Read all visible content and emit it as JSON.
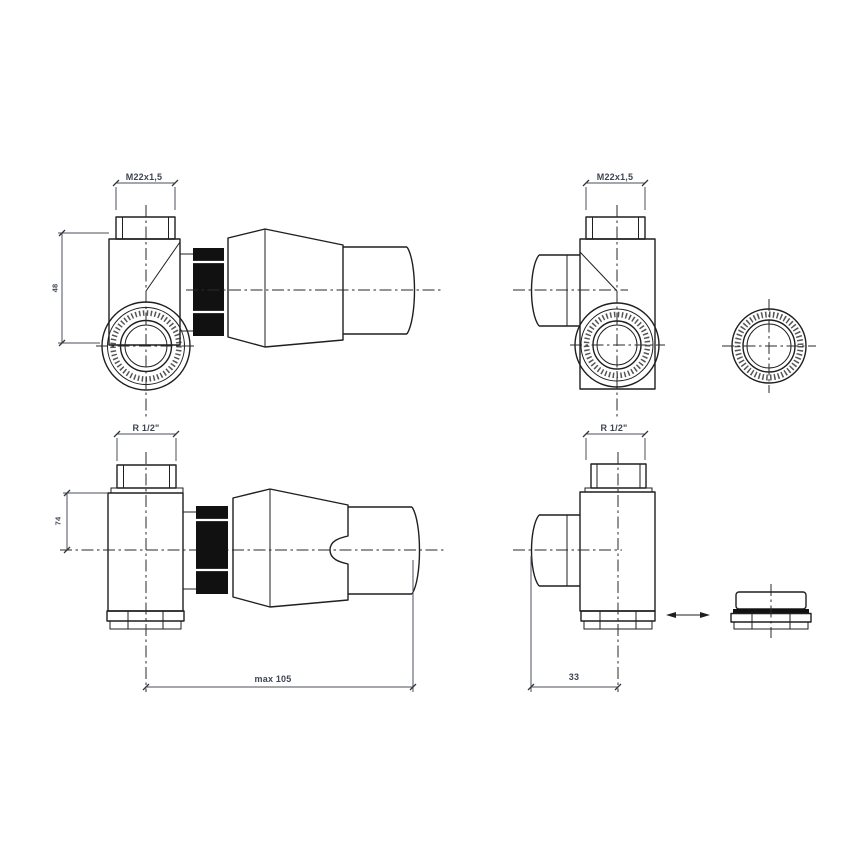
{
  "drawing": {
    "type": "technical-drawing",
    "subject": "Corner thermostatic radiator valve set, four orthographic views with union ring and blanking cap",
    "colors": {
      "background": "#ffffff",
      "line": "#1f1f1f",
      "dark_fill": "#111111",
      "dimension_text": "#3d4553"
    },
    "views": {
      "top_left": {
        "thread_dim": "M22x1,5",
        "height_dim": "48"
      },
      "top_right": {
        "thread_dim": "M22x1,5"
      },
      "bottom_left": {
        "thread_dim": "R 1/2\"",
        "height_dim": "74",
        "length_dim": "max 105"
      },
      "bottom_right": {
        "thread_dim": "R 1/2\"",
        "offset_dim": "33"
      }
    }
  }
}
